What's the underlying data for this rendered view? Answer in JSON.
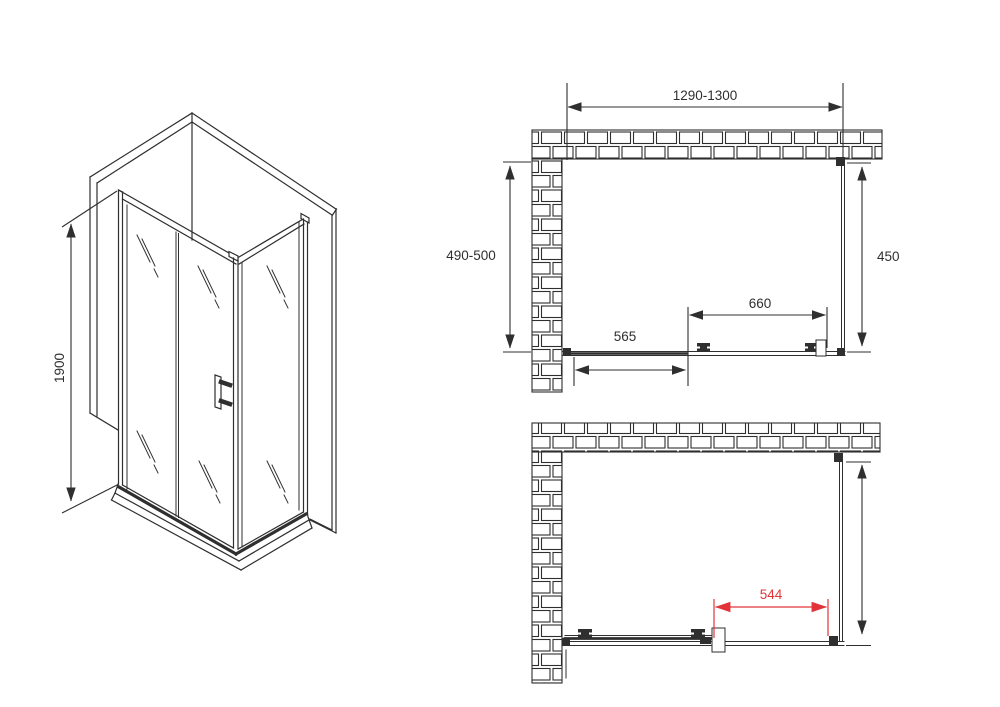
{
  "drawing": {
    "kind": "shower-enclosure-dimension-drawing",
    "colors": {
      "line": "#2f2f2f",
      "accent_red": "#e23438",
      "background": "#ffffff"
    },
    "isometric_view": {
      "height_label": "1900"
    },
    "plan_view_closed": {
      "overall_width_label": "1290-1300",
      "side_wall_depth_label": "490-500",
      "side_panel_width_label": "450",
      "sliding_door_width_label": "660",
      "fixed_panel_width_label": "565"
    },
    "plan_view_open": {
      "door_opening_label": "544"
    }
  }
}
